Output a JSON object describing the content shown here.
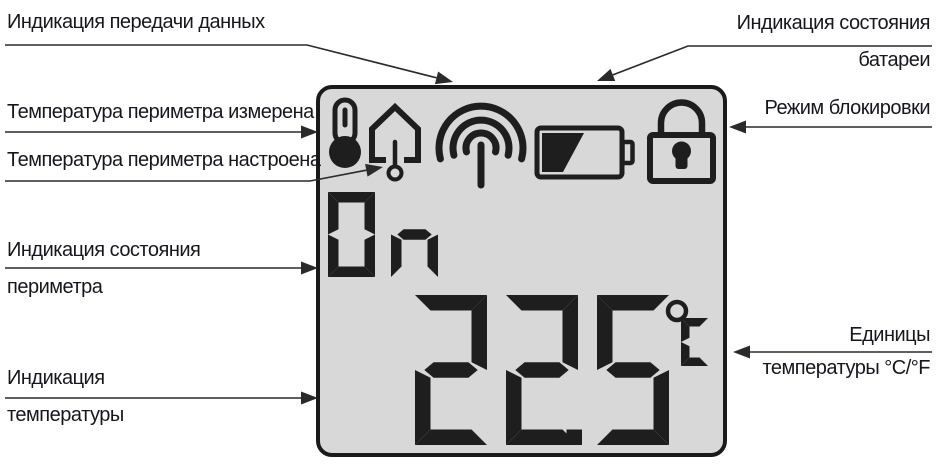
{
  "canvas": {
    "width": 937,
    "height": 471,
    "background": "#ffffff"
  },
  "colors": {
    "display_background": "#d8d8d8",
    "display_border": "#1a1a1a",
    "segment": "#1e1e1e",
    "icon": "#1e1e1e",
    "label_text": "#16161d",
    "arrow": "#2a2a2a"
  },
  "display": {
    "mode": "On",
    "temperature": "22.5",
    "unit": "°C",
    "icons": [
      "thermometer-icon",
      "house-thermometer-icon",
      "signal-icon",
      "battery-icon",
      "lock-icon"
    ]
  },
  "annotations": {
    "data_transmission": "Индикация передачи данных",
    "battery_status": [
      "Индикация состояния",
      "батареи"
    ],
    "perimeter_temp_measured": "Температура периметра измерена",
    "perimeter_temp_set": "Температура периметра настроена",
    "lock_mode": "Режим блокировки",
    "perimeter_status": [
      "Индикация состояния",
      "периметра"
    ],
    "temperature_indication": [
      "Индикация",
      "температуры"
    ],
    "temperature_units": [
      "Единицы",
      "температуры °C/°F"
    ]
  }
}
